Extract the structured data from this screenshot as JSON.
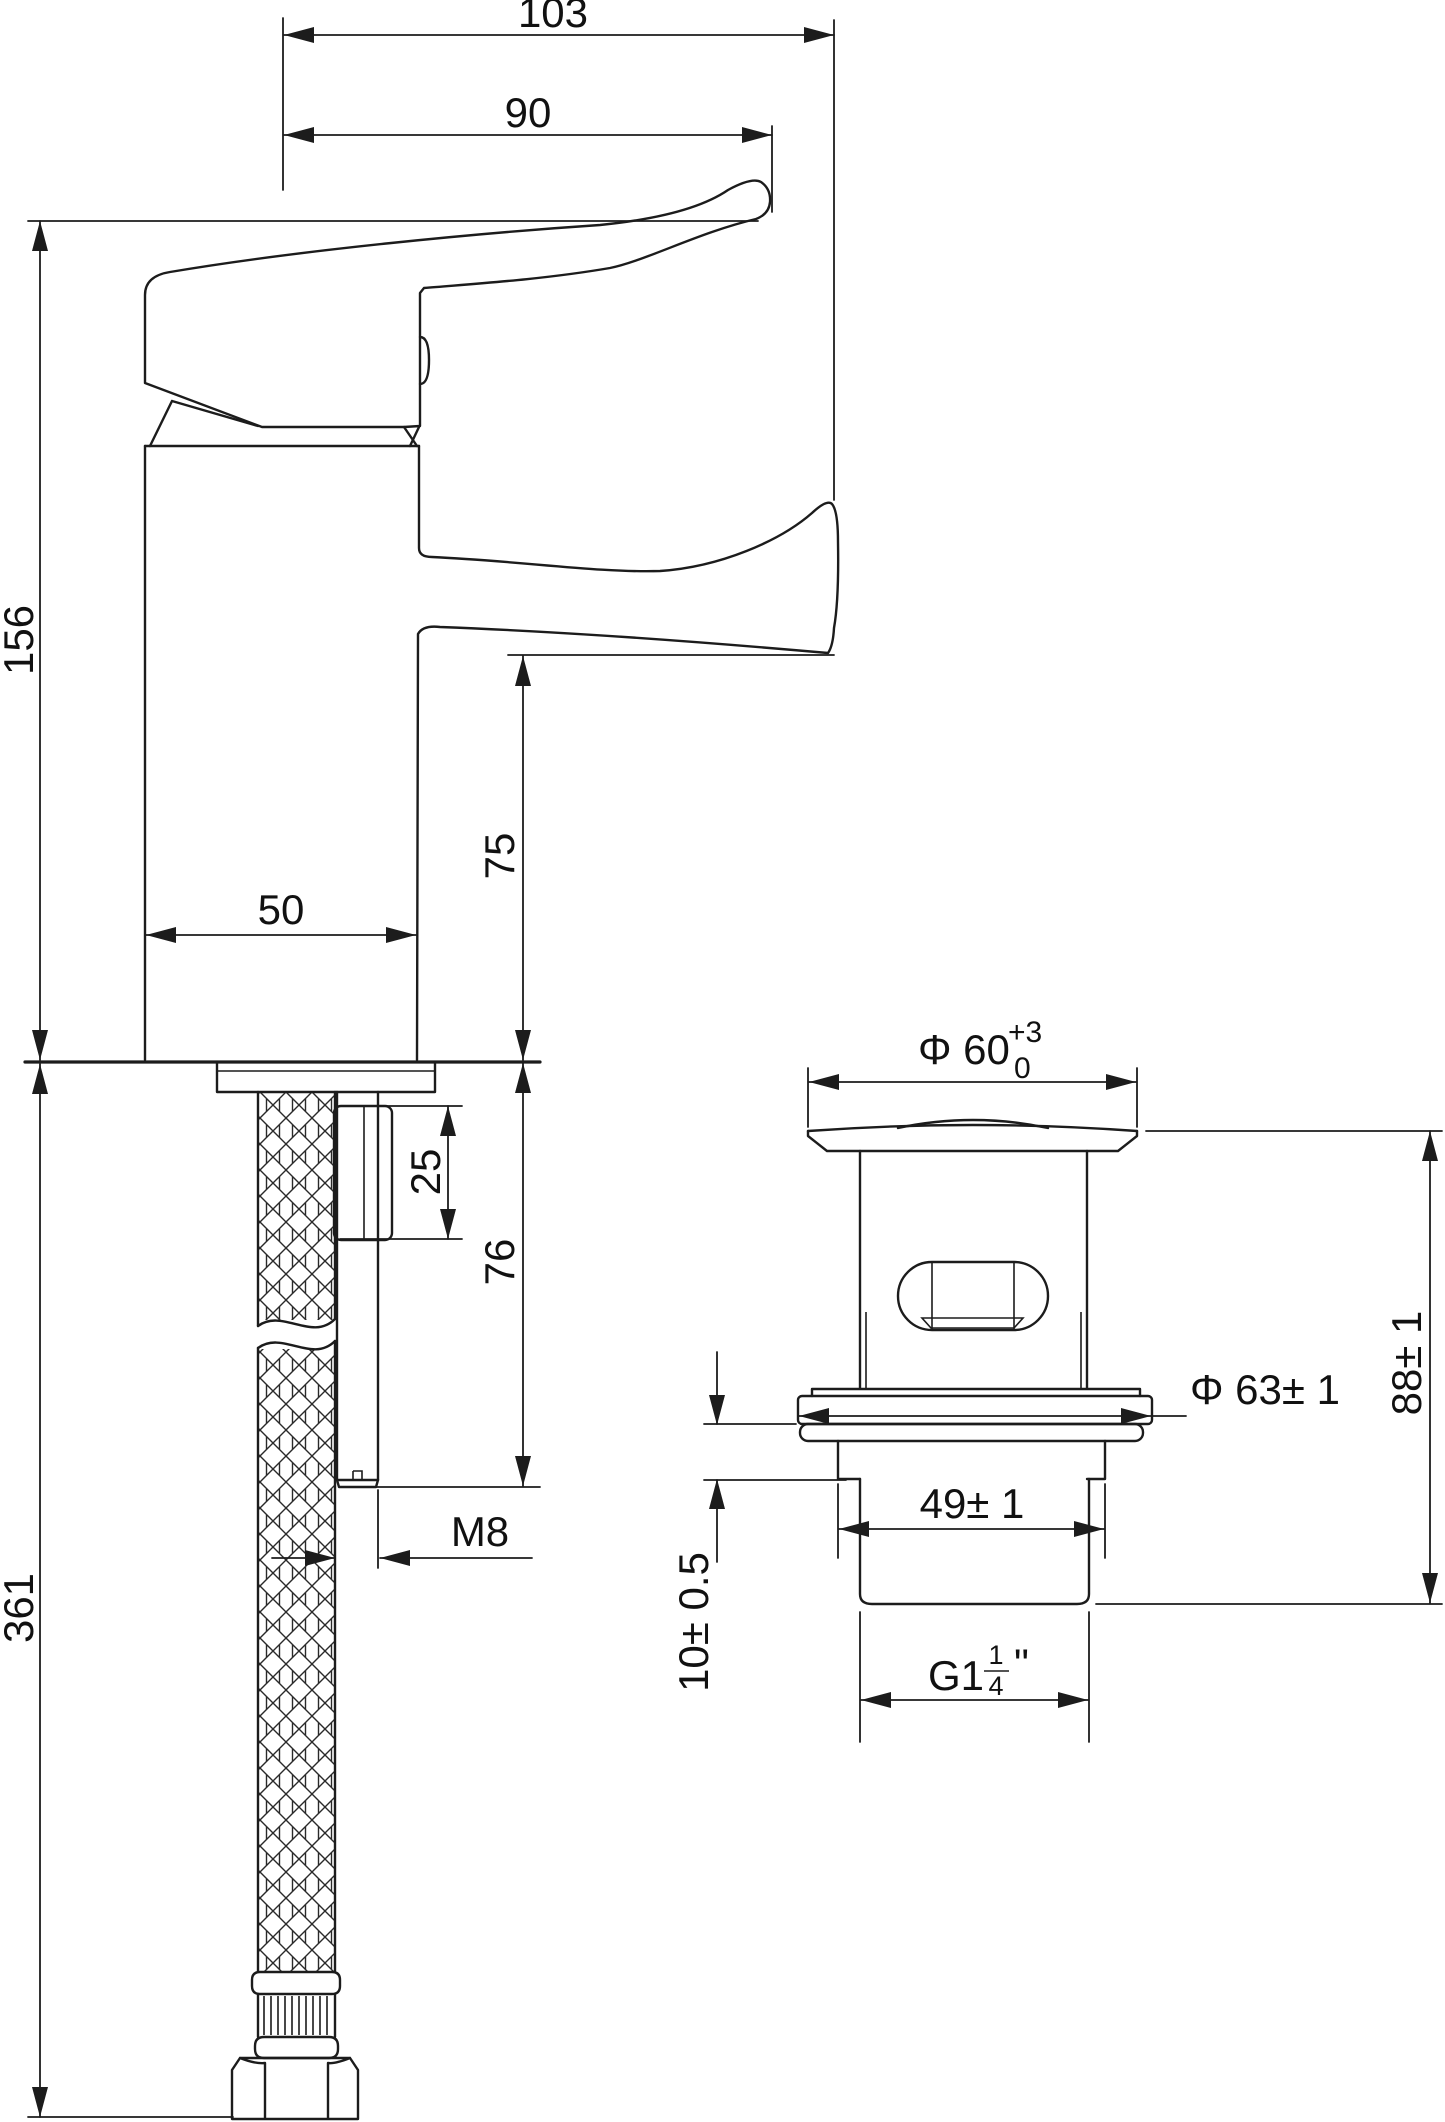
{
  "drawing": {
    "type": "technical-dimension-drawing",
    "views": {
      "faucet_side_view": "basin mixer tap with supply hose and mounting rod",
      "waste_front_view": "pop-up waste drain"
    },
    "units_implied": "mm",
    "dimensions": {
      "spout_reach_overall": "103",
      "handle_reach": "90",
      "total_height_above_deck": "156",
      "spout_clearance": "75",
      "body_width": "50",
      "clamp_length": "25",
      "shank_length_below_deck": "76",
      "hose_length": "361",
      "rod_thread": "M8",
      "waste_top_dia_main": "Φ 60",
      "waste_top_dia_tol_upper": "+3",
      "waste_top_dia_tol_lower": "0",
      "waste_height": "88± 1",
      "waste_disc_dia": "Φ 63± 1",
      "waste_thread_length": "49± 1",
      "waste_gasket_thickness": "10± 0.5",
      "waste_thread_spec_prefix": "G1",
      "waste_thread_spec_frac_num": "1",
      "waste_thread_spec_frac_den": "4",
      "waste_thread_spec_suffix": "\""
    },
    "line_color": "#1c1c1c",
    "background_color": "#ffffff"
  }
}
